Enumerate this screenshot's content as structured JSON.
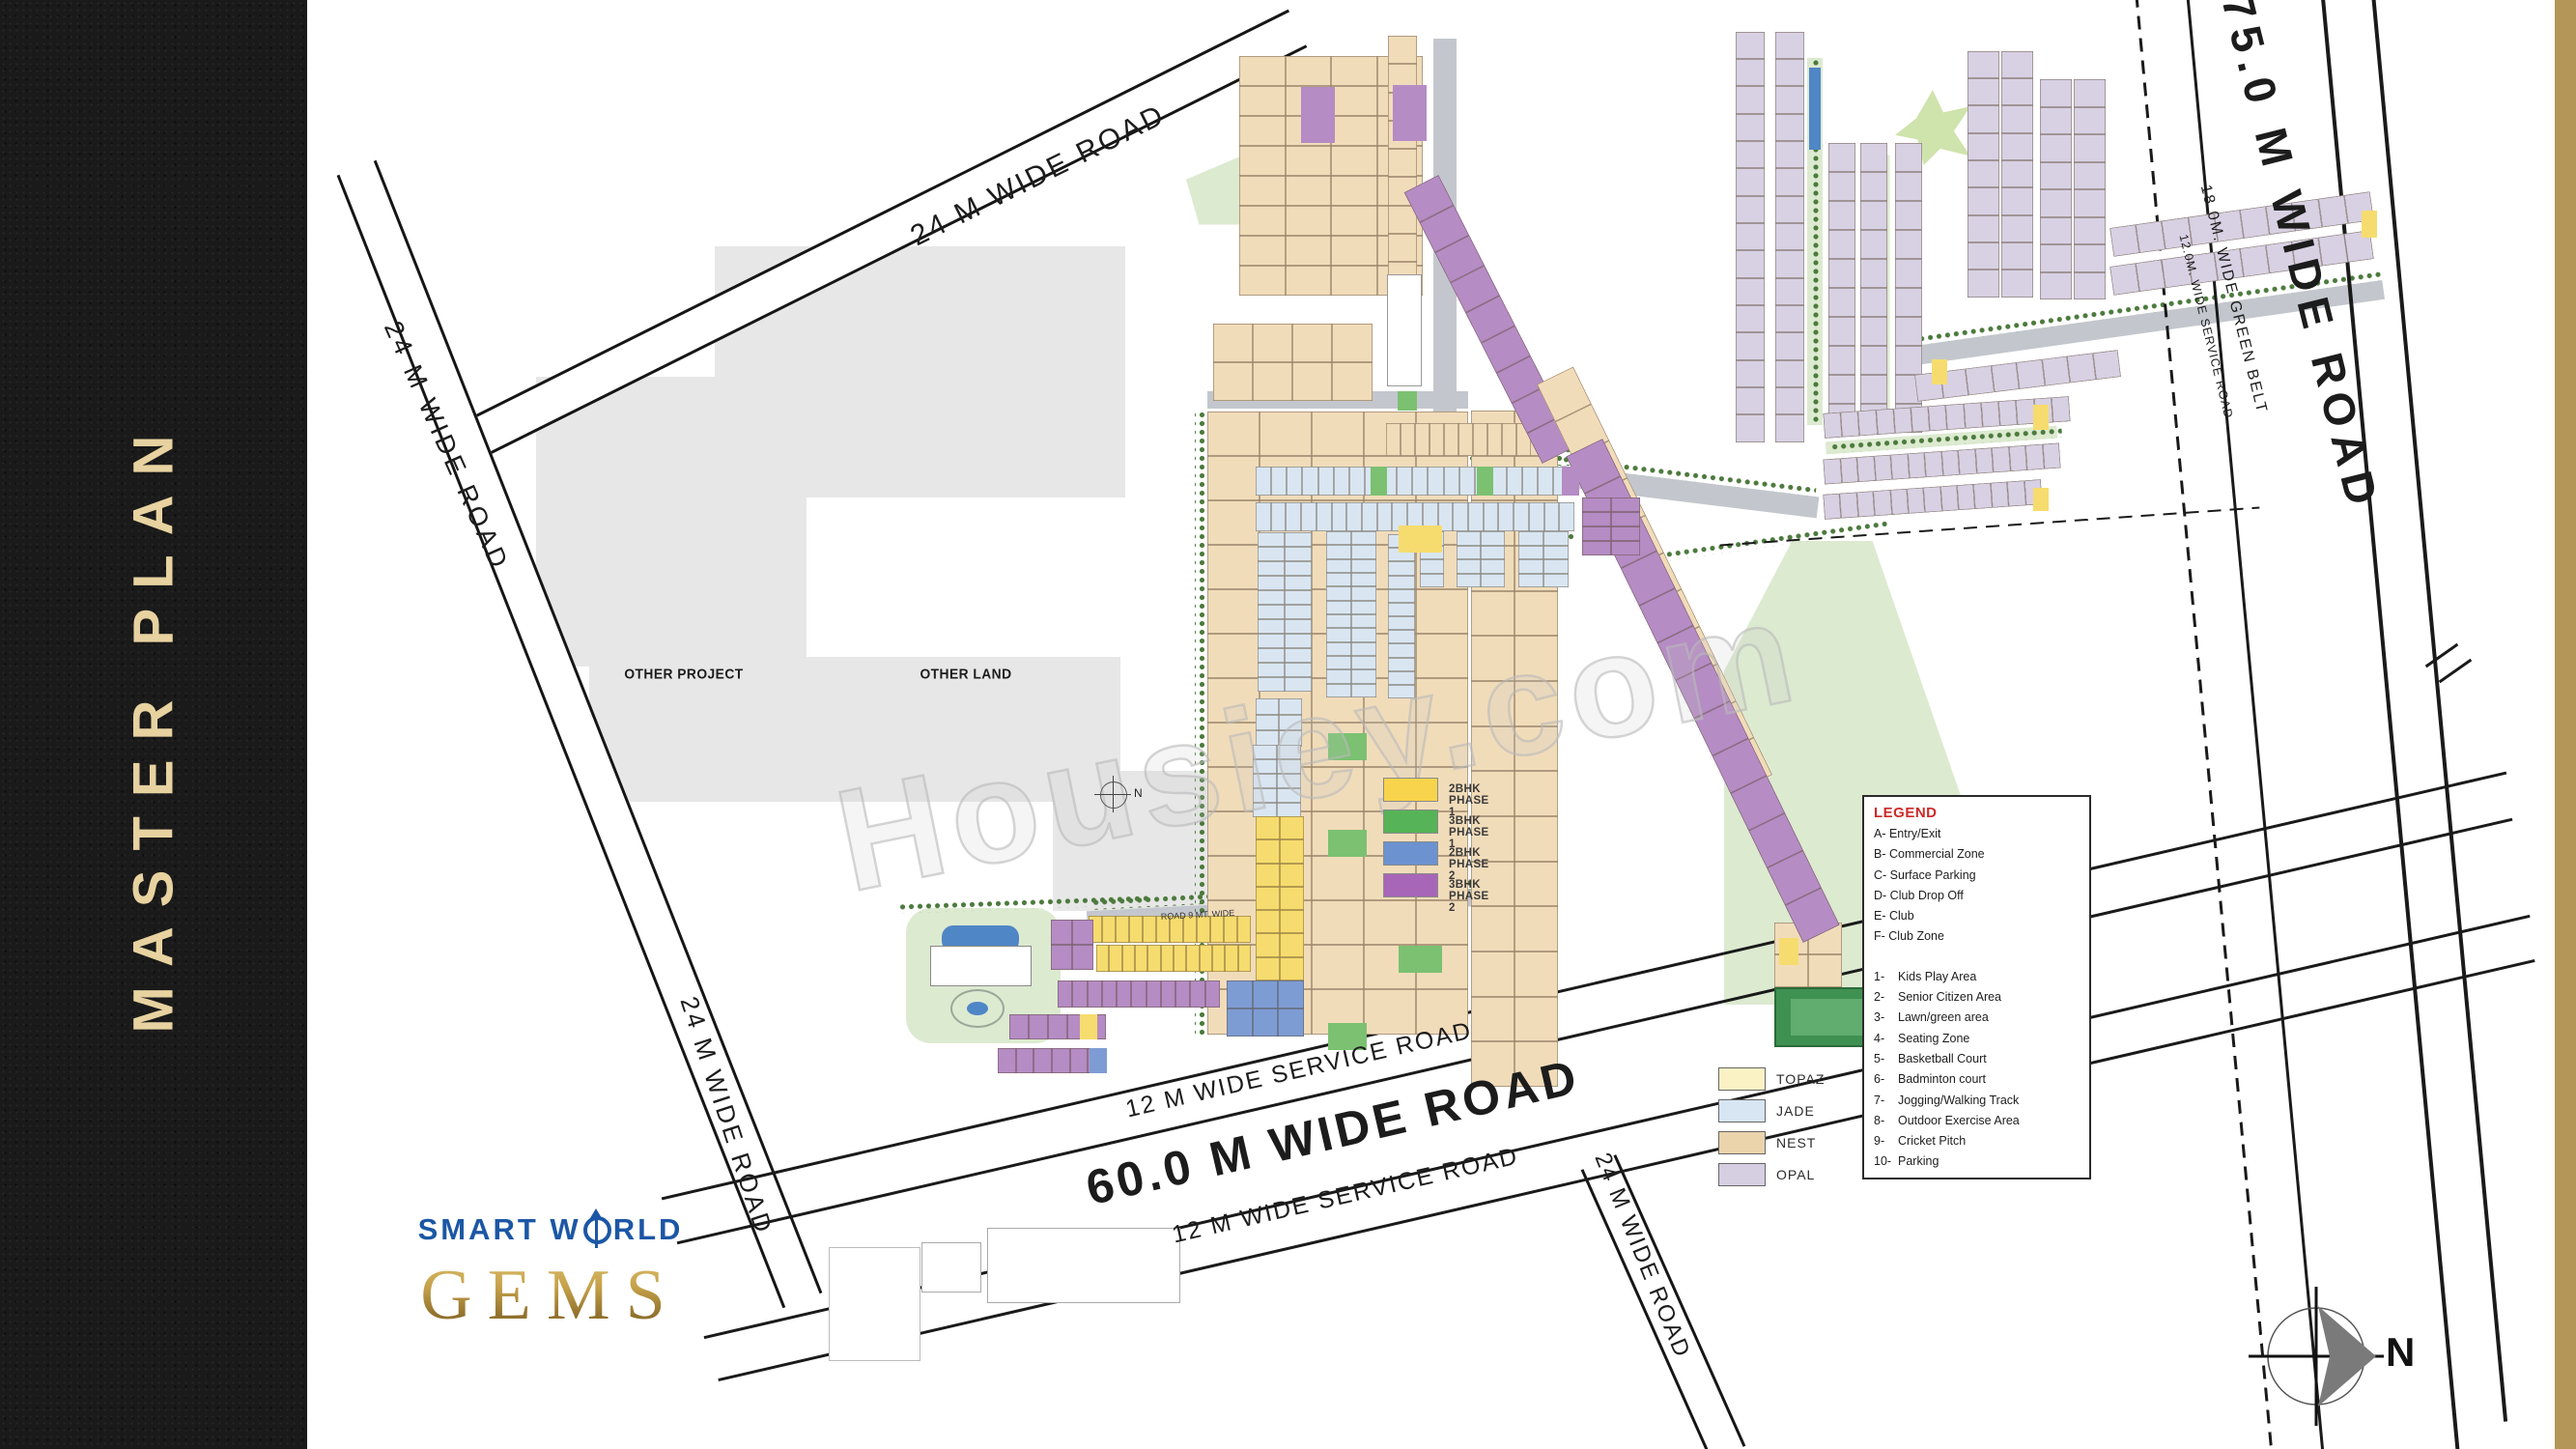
{
  "sidebar": {
    "title": "MASTER PLAN"
  },
  "brand": {
    "smart_pre": "SMART W",
    "smart_post": "RLD",
    "gems": "GEMS"
  },
  "watermark": "Housiey.com",
  "areas": {
    "other_project": "OTHER PROJECT",
    "other_land": "OTHER LAND",
    "internal_road": "ROAD 9 MT. WIDE"
  },
  "roads": {
    "top_24m": "24 M  WIDE ROAD",
    "left_24m": "24 M  WIDE ROAD",
    "left_24m_lower": "24 M  WIDE ROAD",
    "main_60m": "60.0 M  WIDE ROAD",
    "service_12m_upper": "12 M  WIDE SERVICE ROAD",
    "service_12m_lower": "12 M  WIDE SERVICE ROAD",
    "cross_24m": "24 M  WIDE ROAD",
    "right_75m": "75.0 M  WIDE ROAD",
    "green_belt_18m": "18.0M. WIDE GREEN BELT",
    "service_12m_right": "12.0M. WIDE SERVICE ROAD"
  },
  "compass": {
    "north": "N"
  },
  "mini_compass": {
    "north": "N"
  },
  "legend": {
    "title": "LEGEND",
    "letter_items": [
      "A- Entry/Exit",
      "B- Commercial Zone",
      "C- Surface Parking",
      "D- Club Drop Off",
      "E- Club",
      "F- Club Zone"
    ],
    "number_items": [
      "1-    Kids Play Area",
      "2-    Senior Citizen Area",
      "3-    Lawn/green area",
      "4-    Seating Zone",
      "5-    Basketball Court",
      "6-    Badminton court",
      "7-    Jogging/Walking Track",
      "8-    Outdoor Exercise Area",
      "9-    Cricket Pitch",
      "10-  Parking"
    ]
  },
  "phase_legend": [
    {
      "label": "2BHK PHASE 1",
      "color": "#f8d44c"
    },
    {
      "label": "3BHK PHASE 1",
      "color": "#56b357"
    },
    {
      "label": "2BHK PHASE 2",
      "color": "#6c92cf"
    },
    {
      "label": "3BHK PHASE 2",
      "color": "#a866b8"
    }
  ],
  "tower_legend": [
    {
      "label": "TOPAZ",
      "color": "#faf2c5"
    },
    {
      "label": "JADE",
      "color": "#d8e5f2"
    },
    {
      "label": "NEST",
      "color": "#ebd3ac"
    },
    {
      "label": "OPAL",
      "color": "#d6cfe2"
    }
  ],
  "plots": {
    "nest": {
      "prefix": "N",
      "range_visible": "N-01 to N-155"
    },
    "jade": {
      "prefix": "J",
      "range_visible": "J-01 to J-146"
    },
    "opal": {
      "prefix": "O",
      "range_visible": "O-01 to O-210"
    },
    "topaz": {
      "prefix": "T",
      "range_visible": "T-01 to T-88"
    }
  },
  "palette": {
    "nest": "#f1dcba",
    "opal": "#d8d1e3",
    "jade": "#d9e6f2",
    "topaz_bright": "#f6dc6e",
    "purple": "#b58cc4",
    "green_cell": "#7bc171",
    "blue_cell": "#7e9cd4",
    "green_land": "#dcead0",
    "green_land2": "#cfe3ac",
    "gray_area": "#e7e7e7",
    "road_gray": "#c3c7cd",
    "line": "#1a1a1a",
    "white": "#ffffff",
    "pool_blue": "#4f86c6",
    "cricket_green": "#3f9152",
    "cricket_light": "#61ad70",
    "gold_stripe": "#b49659",
    "tree": "#4c7a3d"
  }
}
